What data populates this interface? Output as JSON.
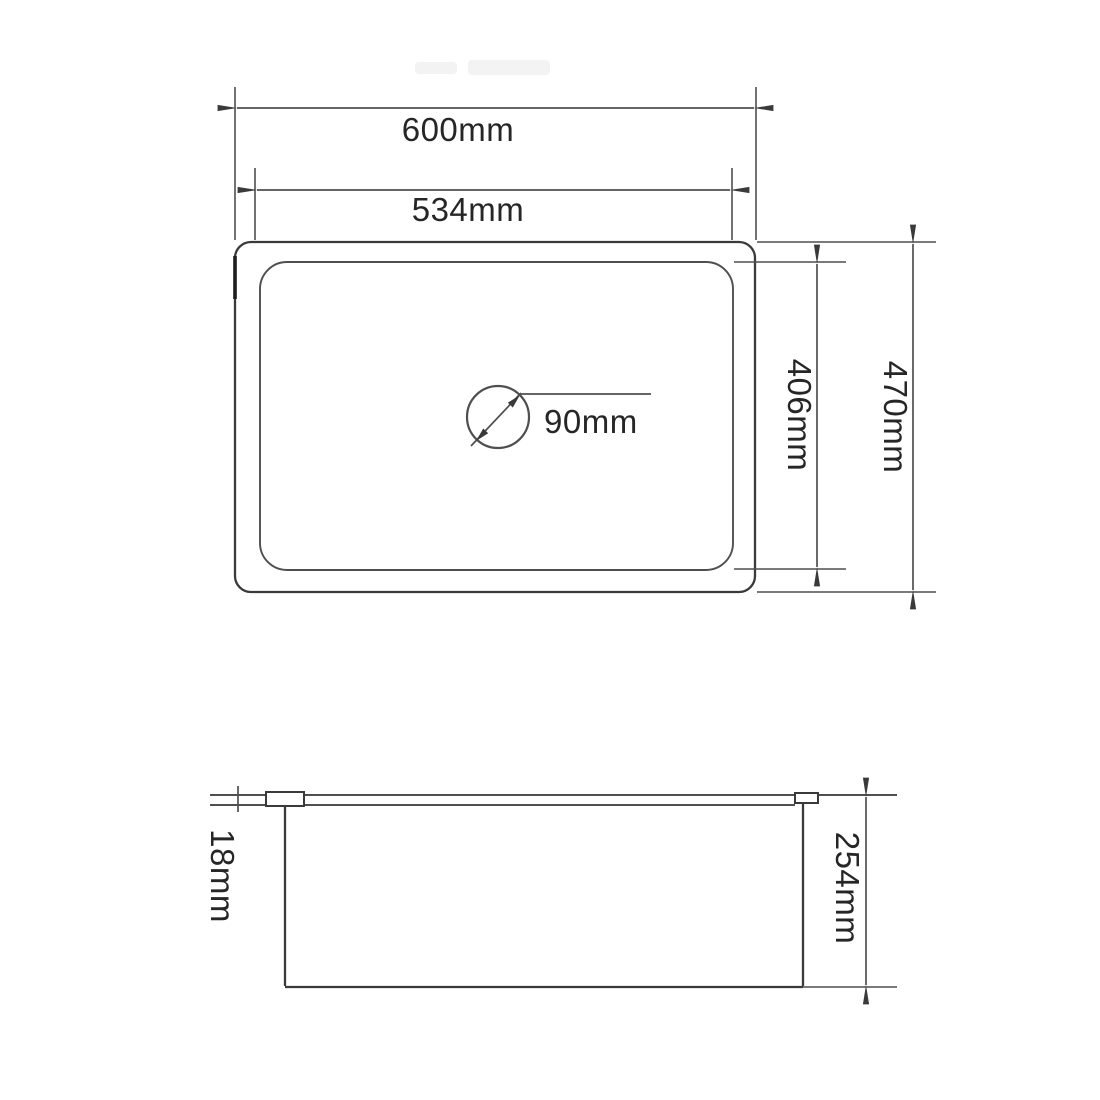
{
  "views": {
    "top": {
      "labels": {
        "outer_width": "600mm",
        "inner_width": "534mm",
        "outer_depth": "470mm",
        "inner_depth": "406mm",
        "drain_diameter": "90mm"
      }
    },
    "side": {
      "labels": {
        "rim_height": "18mm",
        "bowl_depth": "254mm"
      }
    }
  },
  "colors": {
    "line": "#4f4f4f",
    "lineDark": "#3a3a3a",
    "text": "#262626",
    "background": "#ffffff"
  }
}
